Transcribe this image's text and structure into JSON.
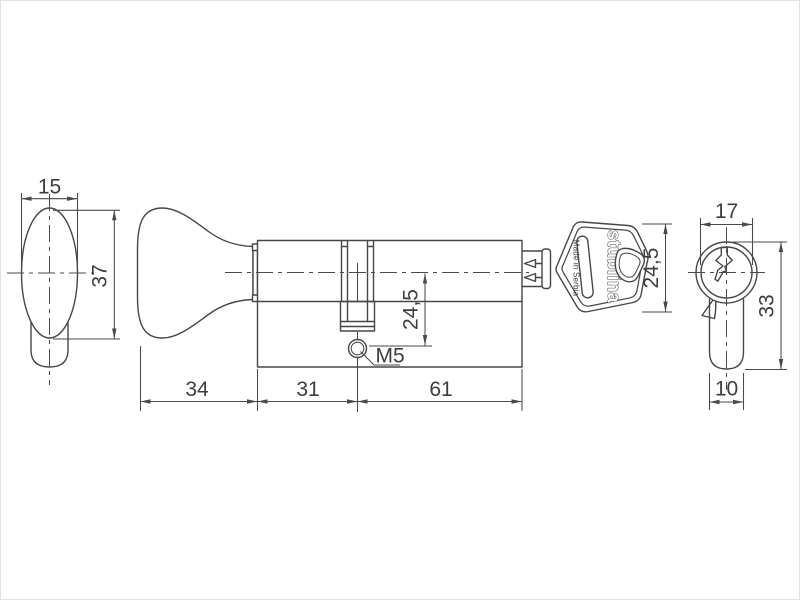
{
  "colors": {
    "line": "#474747",
    "dimension_line": "#4a4a4a",
    "text": "#3d3d3d",
    "background": "#ffffff"
  },
  "views": {
    "thumbturn_end": {
      "width": "15",
      "height": "37"
    },
    "main": {
      "knob_length": "34",
      "body_to_screw": "31",
      "screw_to_end": "61",
      "axis_to_screw": "24,5",
      "screw_thread": "M5"
    },
    "key": {
      "brand": "stublina",
      "origin": "Made in Serbia",
      "head_height": "24,5"
    },
    "profile_end": {
      "plug_diameter": "17",
      "body_height": "33",
      "body_width": "10"
    }
  }
}
